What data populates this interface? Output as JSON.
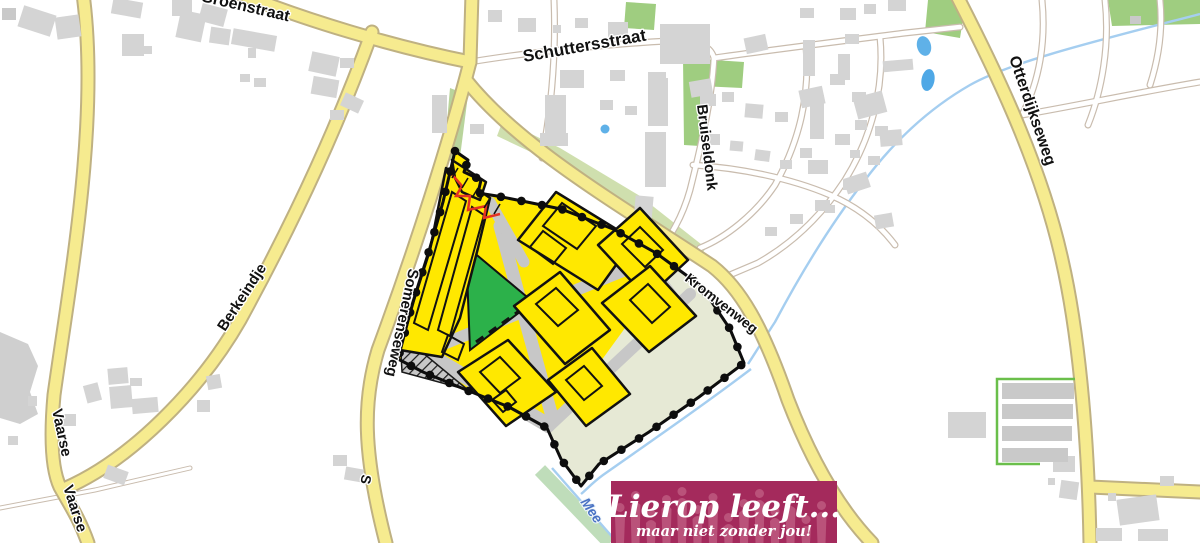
{
  "map": {
    "street_labels": {
      "groenstraat": "Groenstraat",
      "schuttersstraat": "Schuttersstraat",
      "bruiseldonk": "Bruiseldonk",
      "otterdijkseweg": "Otterdijkseweg",
      "berkeindje": "Berkeindje",
      "somerenseweg": "Somerenseweg",
      "kromvenweg": "Kromvenweg",
      "vaarse_1": "Vaarse",
      "vaarse_2": "Vaarse",
      "somerenseweg_fragment": "S",
      "stream_label": "Mee"
    },
    "plan_colors": {
      "housing_yellow": "#FFE800",
      "park_green": "#2CB14A",
      "field_beige": "#E6E9D5",
      "internal_road_gray": "#C7C7C7",
      "boundary_black": "#0D0D0D",
      "accent_red": "#E53222"
    }
  },
  "logo": {
    "title": "Lierop leeft...",
    "subtitle": "maar niet zonder jou!",
    "background": "#A42A5C"
  }
}
